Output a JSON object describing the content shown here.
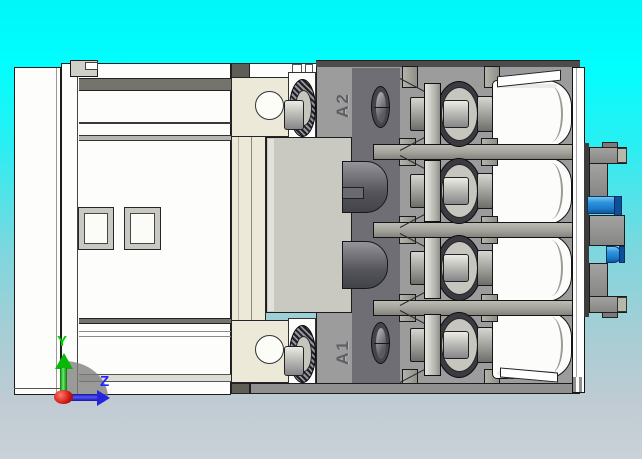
{
  "viewport": {
    "type": "cad-3d-view",
    "background_top_color": "#00ffff",
    "background_bottom_color": "#c9d2d8"
  },
  "model": {
    "name": "contactor-side-view",
    "coil_terminals": [
      {
        "label": "A2",
        "position": "top"
      },
      {
        "label": "A1",
        "position": "bottom"
      }
    ],
    "pole_terminal_count": 4,
    "colors": {
      "housing_gray": "#9c9c9c",
      "body_white": "#fdfdfb",
      "recess_dark": "#6e6e74",
      "coil_block": "#c9c9c1",
      "cream_panel": "#ede9d8",
      "din_clip_blue": "#1d86d8",
      "rail_white": "#ffffff"
    }
  },
  "triad": {
    "axes": [
      {
        "label": "Y",
        "color": "#00cc00",
        "direction": "up"
      },
      {
        "label": "Z",
        "color": "#2222ff",
        "direction": "right"
      }
    ],
    "origin_color": "#cc1510"
  }
}
